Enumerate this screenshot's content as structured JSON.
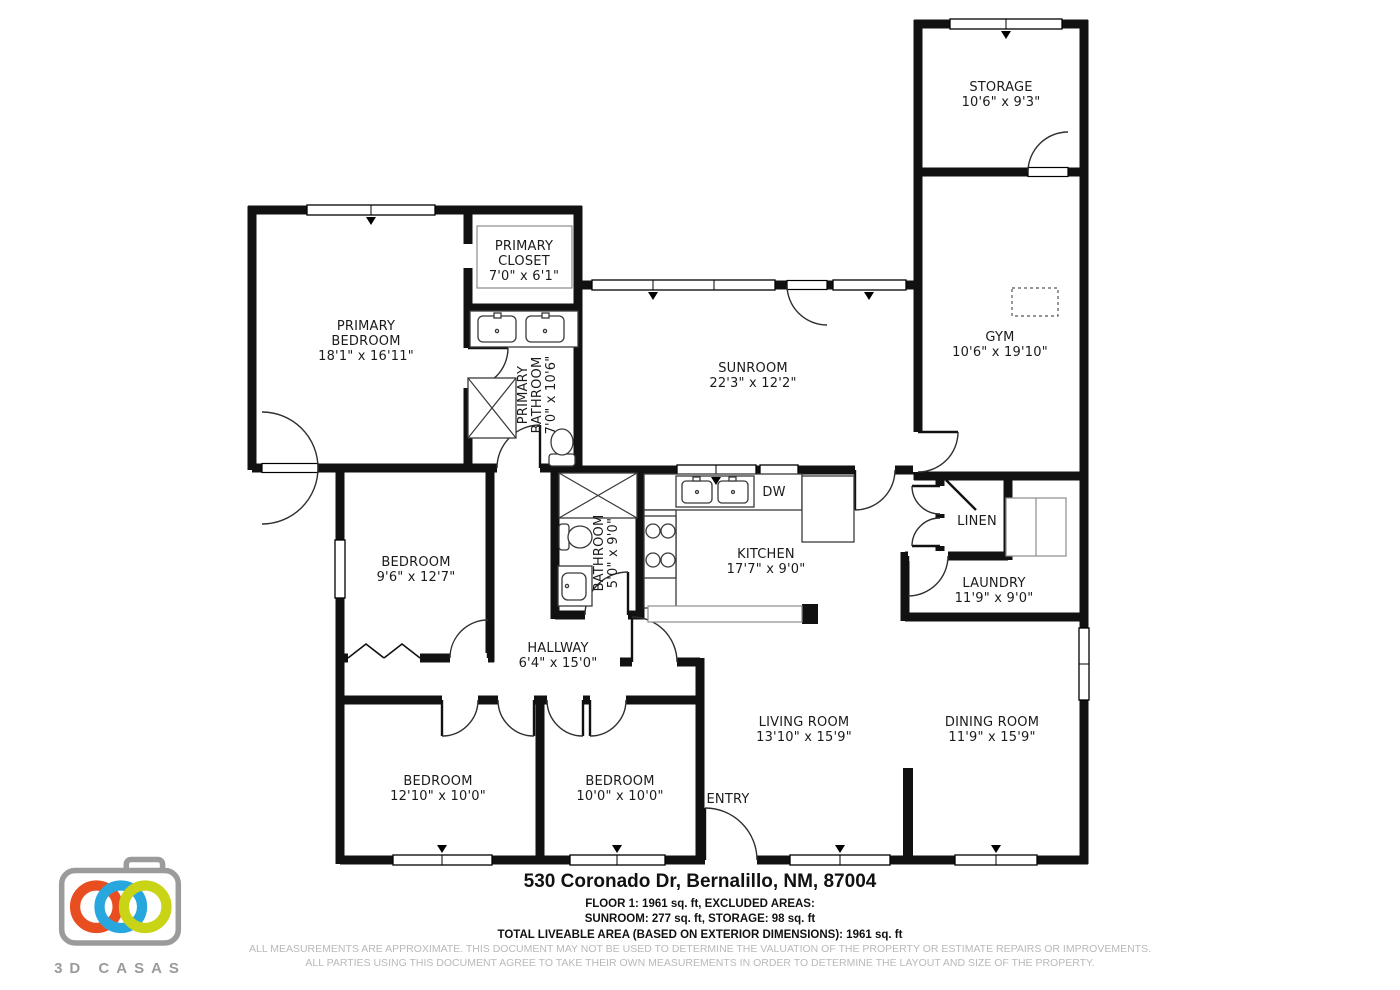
{
  "rooms": {
    "storage": {
      "lines": [
        "STORAGE",
        "10'6\" x 9'3\""
      ]
    },
    "gym": {
      "lines": [
        "GYM",
        "10'6\" x 19'10\""
      ]
    },
    "primary_bedroom": {
      "lines": [
        "PRIMARY",
        "BEDROOM",
        "18'1\" x 16'11\""
      ]
    },
    "primary_closet": {
      "lines": [
        "PRIMARY",
        "CLOSET",
        "7'0\" x 6'1\""
      ]
    },
    "primary_bathroom": {
      "lines": [
        "PRIMARY",
        "BATHROOM",
        "7'0\" x 10'6\""
      ]
    },
    "sunroom": {
      "lines": [
        "SUNROOM",
        "22'3\" x 12'2\""
      ]
    },
    "kitchen": {
      "lines": [
        "KITCHEN",
        "17'7\" x 9'0\""
      ]
    },
    "dishwasher": {
      "label": "DW"
    },
    "linen": {
      "label": "LINEN"
    },
    "laundry": {
      "lines": [
        "LAUNDRY",
        "11'9\" x 9'0\""
      ]
    },
    "bedroom_mid": {
      "lines": [
        "BEDROOM",
        "9'6\" x 12'7\""
      ]
    },
    "bathroom": {
      "lines": [
        "BATHROOM",
        "5'0\" x 9'0\""
      ]
    },
    "hallway": {
      "lines": [
        "HALLWAY",
        "6'4\" x 15'0\""
      ]
    },
    "living_room": {
      "lines": [
        "LIVING ROOM",
        "13'10\" x 15'9\""
      ]
    },
    "dining_room": {
      "lines": [
        "DINING ROOM",
        "11'9\" x 15'9\""
      ]
    },
    "bedroom_left": {
      "lines": [
        "BEDROOM",
        "12'10\" x 10'0\""
      ]
    },
    "bedroom_right": {
      "lines": [
        "BEDROOM",
        "10'0\" x 10'0\""
      ]
    },
    "entry": {
      "label": "ENTRY"
    }
  },
  "footer": {
    "address": "530 Coronado Dr, Bernalillo, NM, 87004",
    "line1": "FLOOR 1: 1961 sq. ft, EXCLUDED AREAS:",
    "line2": "SUNROOM: 277 sq. ft, STORAGE: 98 sq. ft",
    "line3": "TOTAL LIVEABLE AREA (BASED ON EXTERIOR DIMENSIONS): 1961 sq. ft",
    "disclaimer1": "ALL MEASUREMENTS ARE APPROXIMATE. THIS DOCUMENT MAY NOT BE USED TO DETERMINE THE VALUATION OF THE PROPERTY OR ESTIMATE REPAIRS OR IMPROVEMENTS.",
    "disclaimer2": "ALL PARTIES USING THIS DOCUMENT AGREE TO TAKE THEIR OWN MEASUREMENTS IN ORDER TO DETERMINE THE LAYOUT AND SIZE OF THE PROPERTY."
  },
  "logo": {
    "text": "3D CASAS",
    "colors": {
      "ring_red": "#e84e1f",
      "ring_blue": "#28a7de",
      "ring_green": "#c9d417",
      "body_gray": "#9b9b9b"
    }
  }
}
